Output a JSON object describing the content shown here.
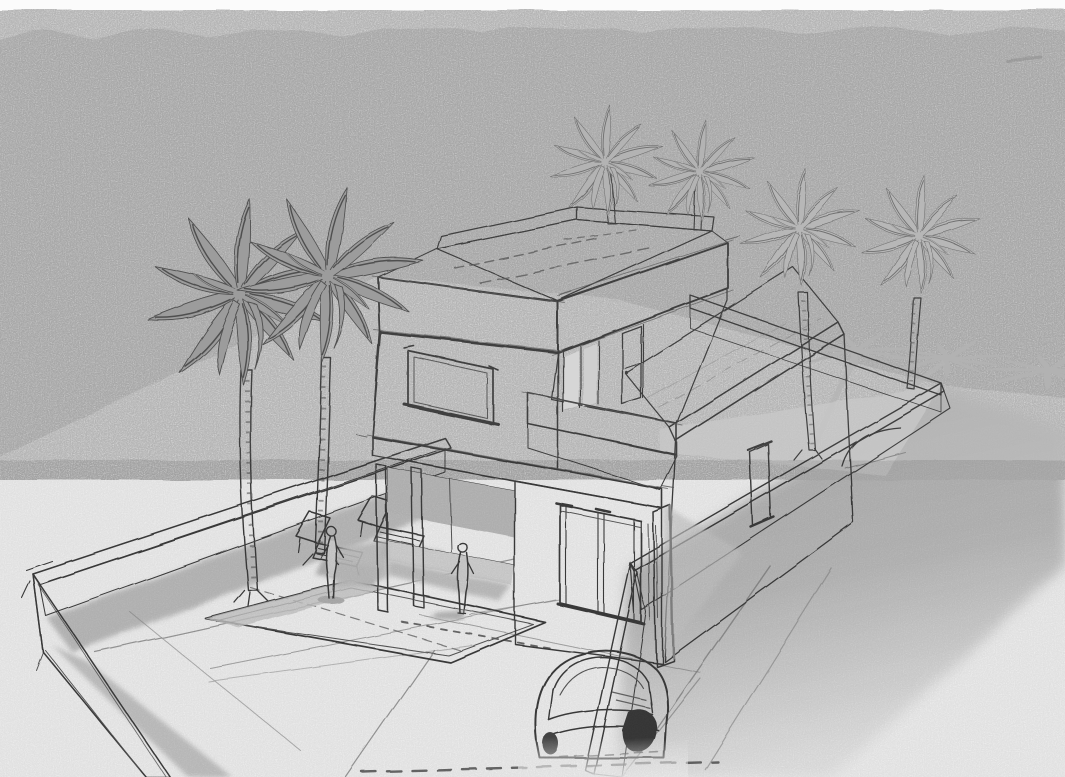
{
  "scene": {
    "type": "architectural-concept-sketch",
    "description": "Grayscale hand-drawn perspective sketch on textured paper: a modern two-storey flat-roof villa with roof terrace and parapet, balcony with sliding glass doors, ground-floor french doors, covered porch with slender columns, a single-storey wing with small window, a walled courtyard containing a swimming pool, two sun loungers and two standing figures, six palm trees (two tall ones in the courtyard, two behind the roof terrace, two behind the house casting star-shaped shadows), a long cast shadow band along the right boundary wall and a partially sketched car at the driveway.",
    "medium": "pencil and ink style render, no text, no color",
    "palette": {
      "paper": "#fbfbfb",
      "sky_band": "#e9e9e9",
      "ink": "#3f3f3f",
      "wall_shade_light": "#cccccc",
      "wall_shade_mid": "#bdbdbd",
      "ground_shadow": "#b4b4b4",
      "palm_frond_dark": "#999999",
      "palm_frond_light": "#b7b7b7",
      "glazing": "#d4d4d4"
    },
    "elements": [
      {
        "name": "sky-band",
        "label": "textured grey sky band of sketch paper"
      },
      {
        "name": "house-main-block",
        "label": "two-storey main block with flat roof terrace"
      },
      {
        "name": "roof-terrace",
        "label": "roof terrace deck with parapet walls"
      },
      {
        "name": "upper-window",
        "label": "square window on upper front facade"
      },
      {
        "name": "balcony",
        "label": "first floor balcony parapet with sliding glass doors"
      },
      {
        "name": "french-doors",
        "label": "ground floor double french doors"
      },
      {
        "name": "porch",
        "label": "recessed porch with two slender columns"
      },
      {
        "name": "single-storey-wing",
        "label": "single storey wing with flat grey roof and small window"
      },
      {
        "name": "perimeter-wall",
        "label": "low white boundary wall around the plot"
      },
      {
        "name": "swimming-pool",
        "label": "rectangular swimming pool in courtyard"
      },
      {
        "name": "sun-loungers",
        "label": "two sketched sun loungers with cast shadows"
      },
      {
        "name": "person-1",
        "label": "standing figure near the loungers"
      },
      {
        "name": "person-2",
        "label": "standing figure on the courtyard paving"
      },
      {
        "name": "palm-trees",
        "label": "six palm trees, two tall in courtyard, four behind house"
      },
      {
        "name": "palm-shadows",
        "label": "star shaped palm canopy shadows on ground at right"
      },
      {
        "name": "wall-shadow",
        "label": "long soft shadow band cast by right boundary wall"
      },
      {
        "name": "car",
        "label": "partially sketched car at the driveway gate"
      },
      {
        "name": "courtyard-paving",
        "label": "sketchy paving seams and tick marks"
      }
    ]
  }
}
